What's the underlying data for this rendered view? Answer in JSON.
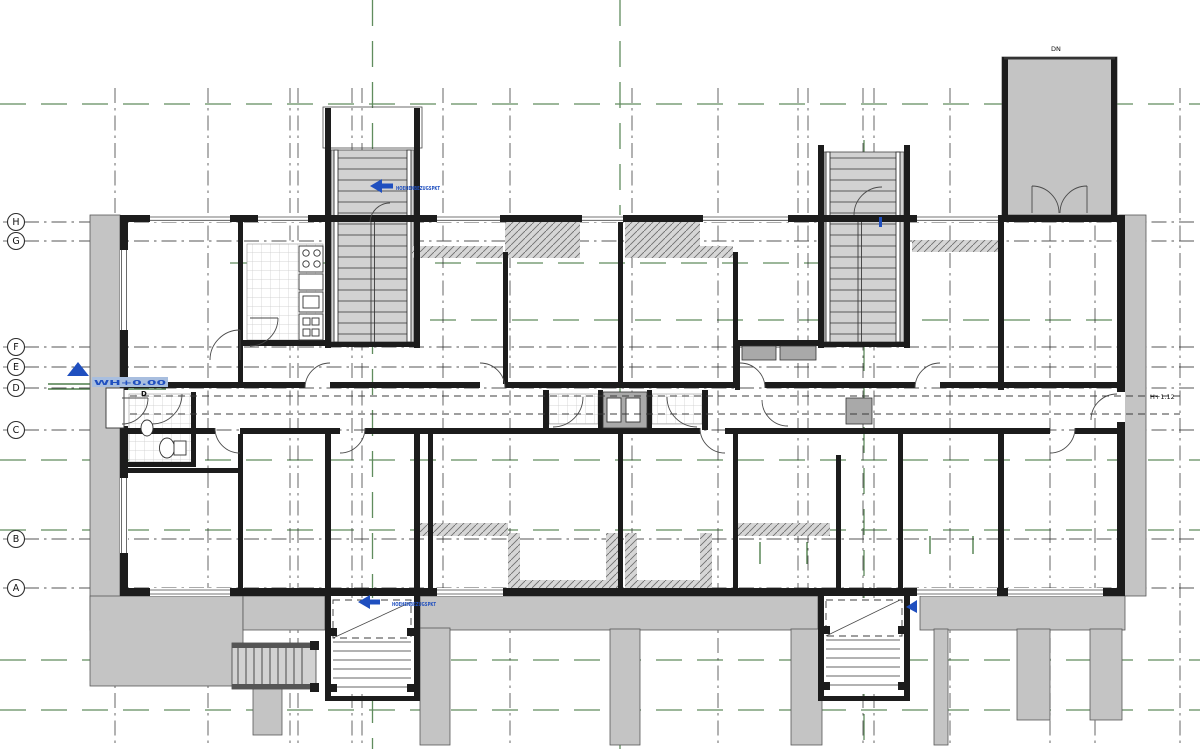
{
  "document": {
    "type": "architectural-floor-plan",
    "bg": "#ffffff"
  },
  "grid_bubbles": [
    {
      "label": "H"
    },
    {
      "label": "G"
    },
    {
      "label": "F"
    },
    {
      "label": "E"
    },
    {
      "label": "D"
    },
    {
      "label": "C"
    },
    {
      "label": "B"
    },
    {
      "label": "A"
    }
  ],
  "labels": {
    "garage_dn": "DN",
    "entry_door": "D",
    "corridor_height": "H+1.12",
    "level_marker": "WH+0.00",
    "stair_note_upper": "HOEHENBEZUGSPKT",
    "stair_note_lower": "HOEHENBEZUGSPKT"
  },
  "colors": {
    "centerline": "#4f7f4c",
    "gridline": "#2b2b2b",
    "wall": "#1c1c1c",
    "poche": "#c4c4c4",
    "stairbg": "#d2d2d2",
    "hatchbase": "#d6d6d6",
    "blue": "#1f4fbf",
    "paper": "#ffffff"
  }
}
